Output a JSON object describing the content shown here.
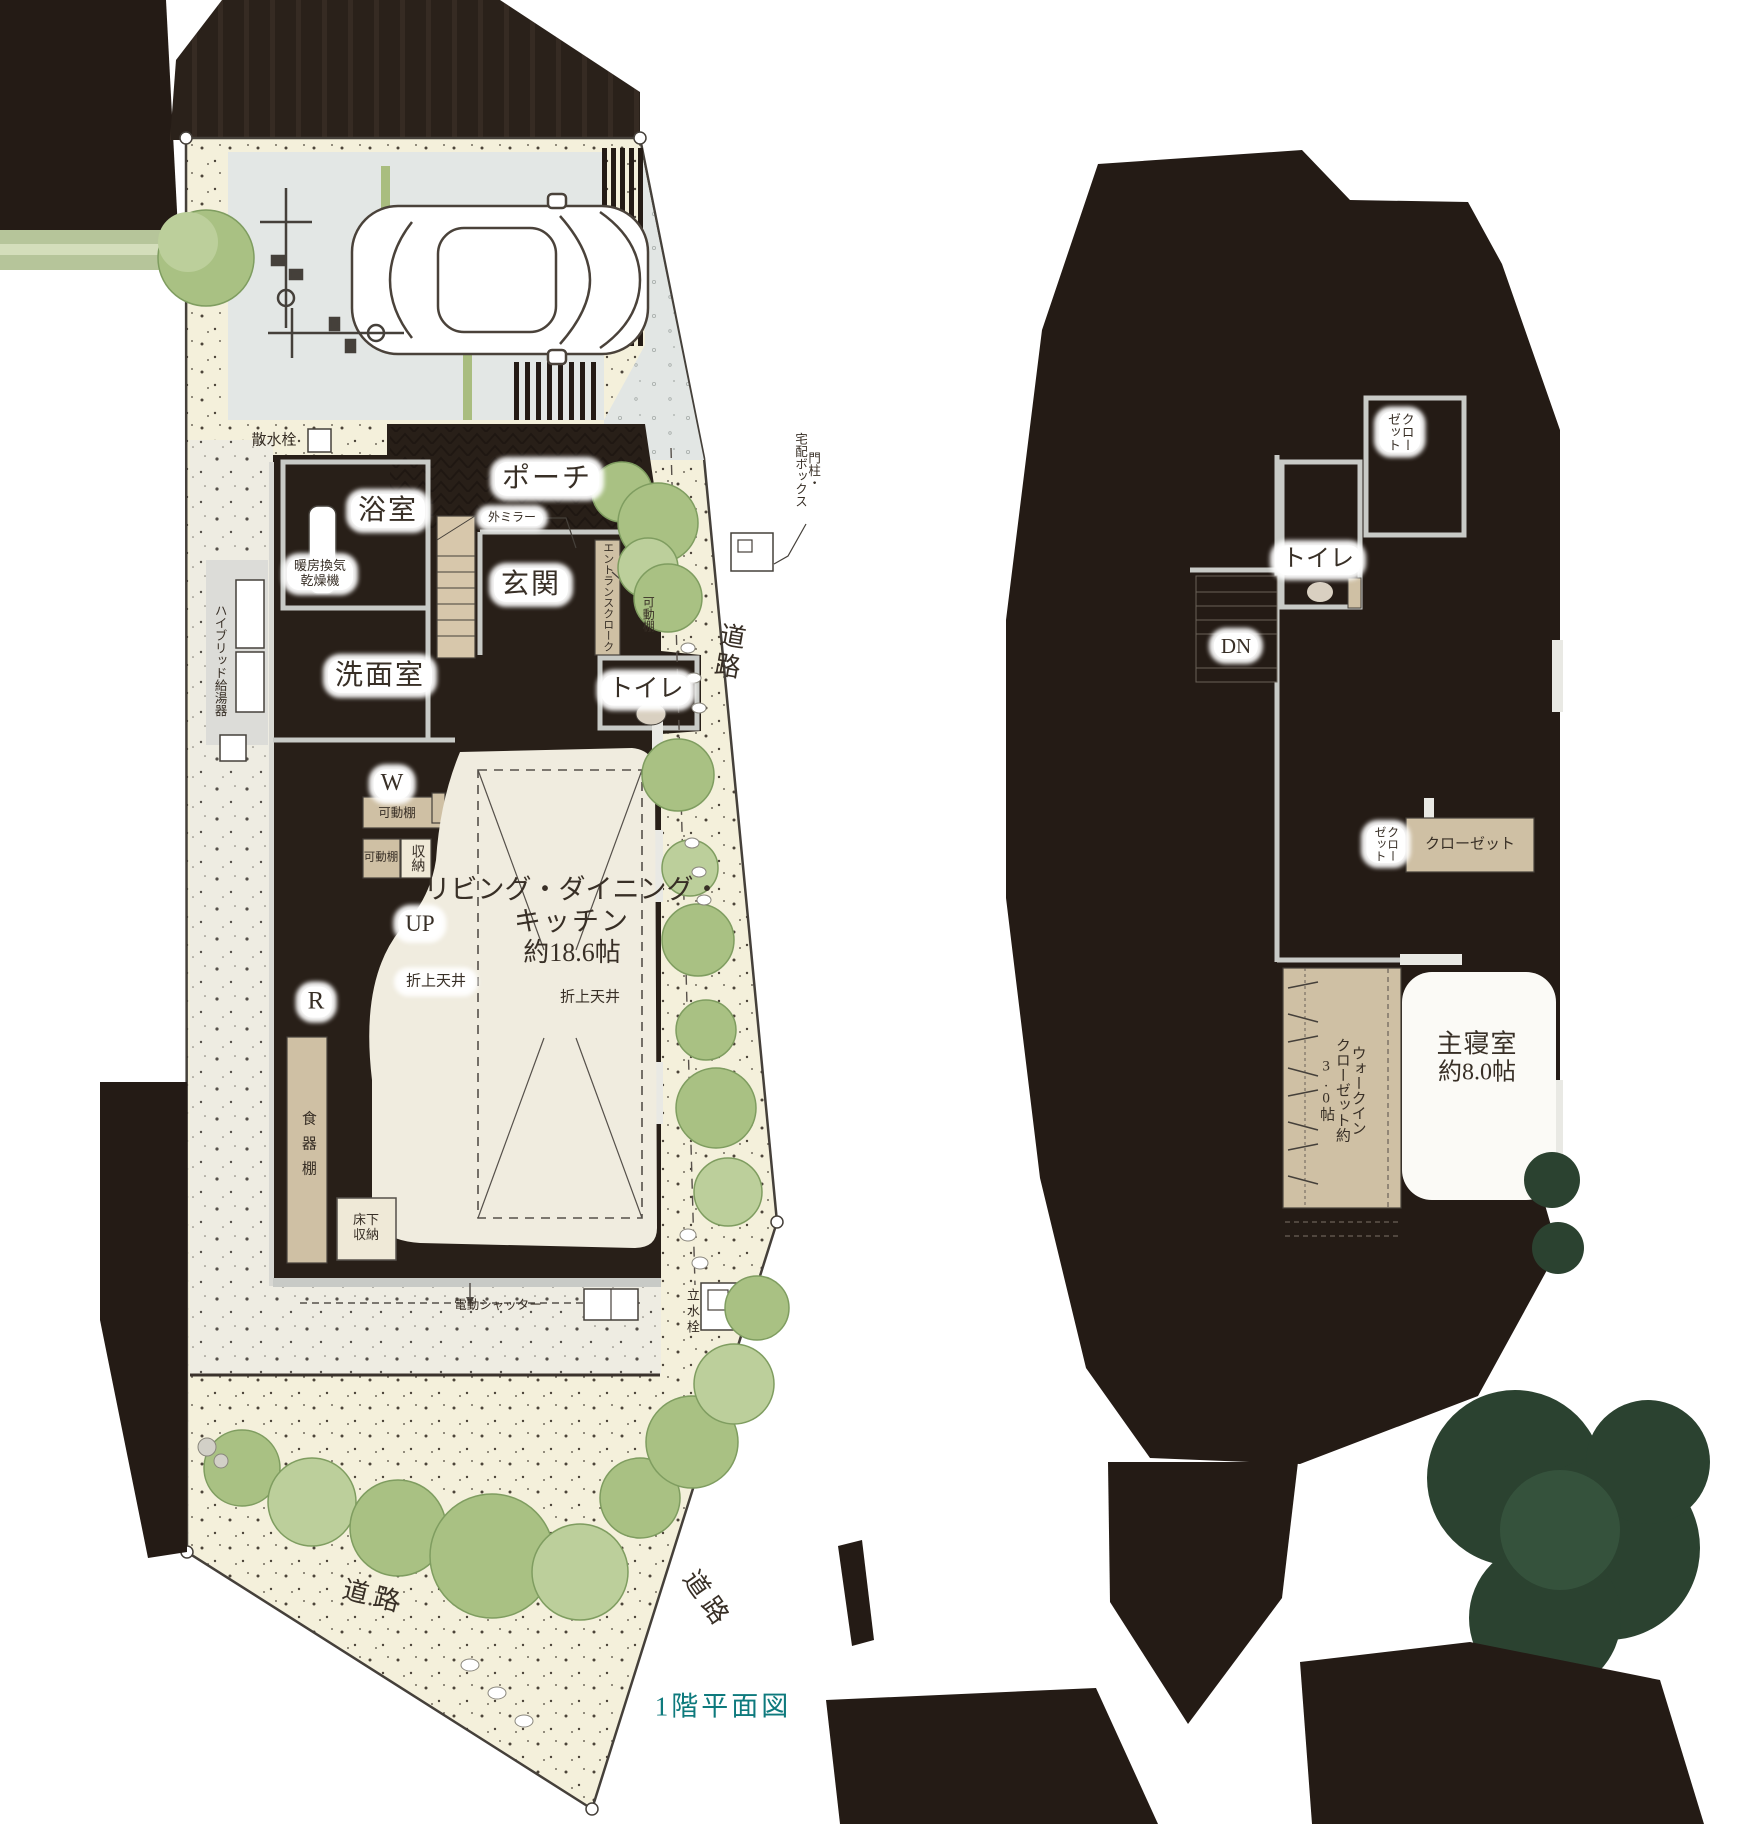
{
  "caption": "1階平面図",
  "colors": {
    "accent_teal": "#0e7a7d",
    "wall_dark": "#241b15",
    "furniture_tan": "#cfc0a4",
    "tree_green": "#a9c183",
    "dark_tree_green": "#2b4230",
    "ground_cream": "#f4f0db",
    "concrete_gray": "#e3e7e5"
  },
  "floor1": {
    "bath": "浴室",
    "porch": "ポーチ",
    "entrance": "玄関",
    "washroom": "洗面室",
    "toilet": "トイレ",
    "ldk1": "リビング・ダイニング・",
    "ldk2": "キッチン",
    "ldk3": "約18.6帖",
    "coffered": "折上天井",
    "up": "UP",
    "washer": "W",
    "fridge": "R",
    "sprinkler": "散水栓",
    "mirror": "外ミラー",
    "heater1": "暖房換気",
    "heater2": "乾燥機",
    "cloak": "エントランスクローク",
    "shelf": "可動棚",
    "pillar": "門柱・",
    "delivery": "宅配ボックス",
    "hybrid": "ハイブリッド給湯器",
    "storage": "収納",
    "cupboard": "食器棚",
    "floor_storage1": "床下",
    "floor_storage2": "収納",
    "shutter": "電動シャッター",
    "tap": "立水栓",
    "road": "道路"
  },
  "floor2": {
    "toilet": "トイレ",
    "dn": "DN",
    "closet1": "クロー",
    "closet2": "ゼット",
    "closet": "クローゼット",
    "wic1": "ウォークイン",
    "wic2": "クローゼット約",
    "wic3": "3.0帖",
    "master1": "主寝室",
    "master2": "約8.0帖"
  }
}
